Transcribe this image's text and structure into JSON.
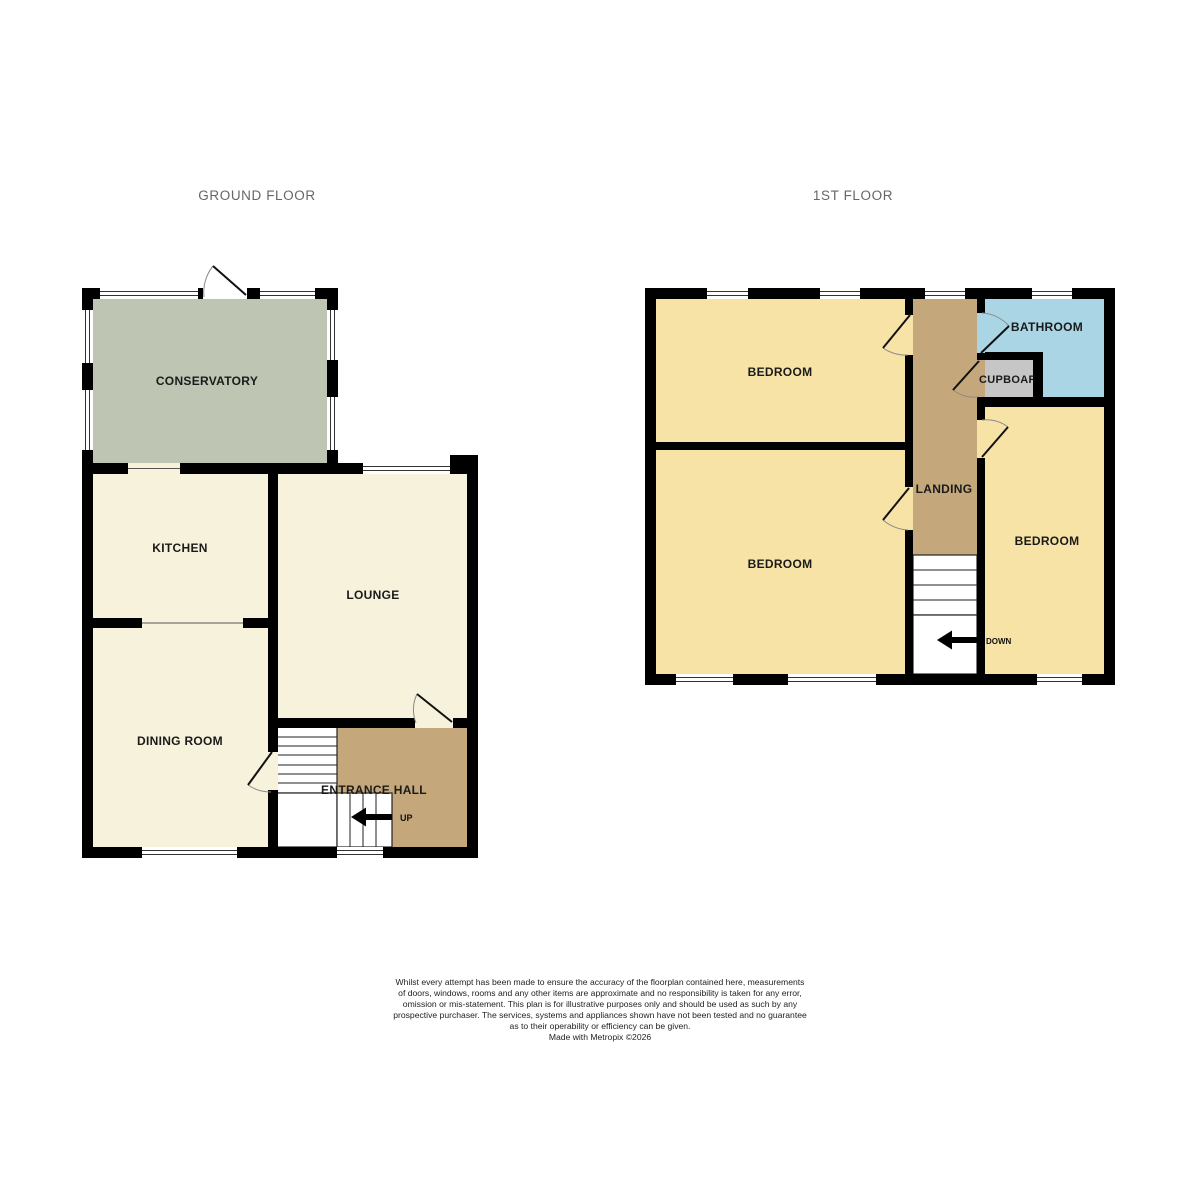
{
  "ground_floor": {
    "title": "GROUND FLOOR",
    "rooms": [
      {
        "name": "conservatory",
        "label": "CONSERVATORY"
      },
      {
        "name": "kitchen",
        "label": "KITCHEN"
      },
      {
        "name": "lounge",
        "label": "LOUNGE"
      },
      {
        "name": "dining-room",
        "label": "DINING ROOM"
      },
      {
        "name": "entrance-hall",
        "label": "ENTRANCE HALL"
      }
    ],
    "stair_direction_label": "UP"
  },
  "first_floor": {
    "title": "1ST FLOOR",
    "rooms": [
      {
        "name": "bedroom-front",
        "label": "BEDROOM"
      },
      {
        "name": "bedroom-back",
        "label": "BEDROOM"
      },
      {
        "name": "bedroom-side",
        "label": "BEDROOM"
      },
      {
        "name": "bathroom",
        "label": "BATHROOM"
      },
      {
        "name": "cupboard",
        "label": "CUPBOARD"
      },
      {
        "name": "landing",
        "label": "LANDING"
      }
    ],
    "stair_direction_label": "DOWN"
  },
  "colors": {
    "wall": "#000000",
    "ground_room_fill": "#F7F2DC",
    "conservatory_fill": "#BFC5B3",
    "hall_landing_fill": "#C5A77C",
    "bedroom_fill": "#F7E3A5",
    "bathroom_fill": "#A9D5E4",
    "cupboard_fill": "#C6C6C6",
    "title_text": "#666666",
    "label_text": "#1A1A1A"
  },
  "footer": {
    "disclaimer_lines": [
      "Whilst every attempt has been made to ensure the accuracy of the floorplan contained here, measurements",
      "of doors, windows, rooms and any other items are approximate and no responsibility is taken for any error,",
      "omission or mis-statement. This plan is for illustrative purposes only and should be used as such by any",
      "prospective purchaser. The services, systems and appliances shown have not been tested and no guarantee",
      "as to their operability or efficiency can be given.",
      "Made with Metropix ©2026"
    ]
  }
}
